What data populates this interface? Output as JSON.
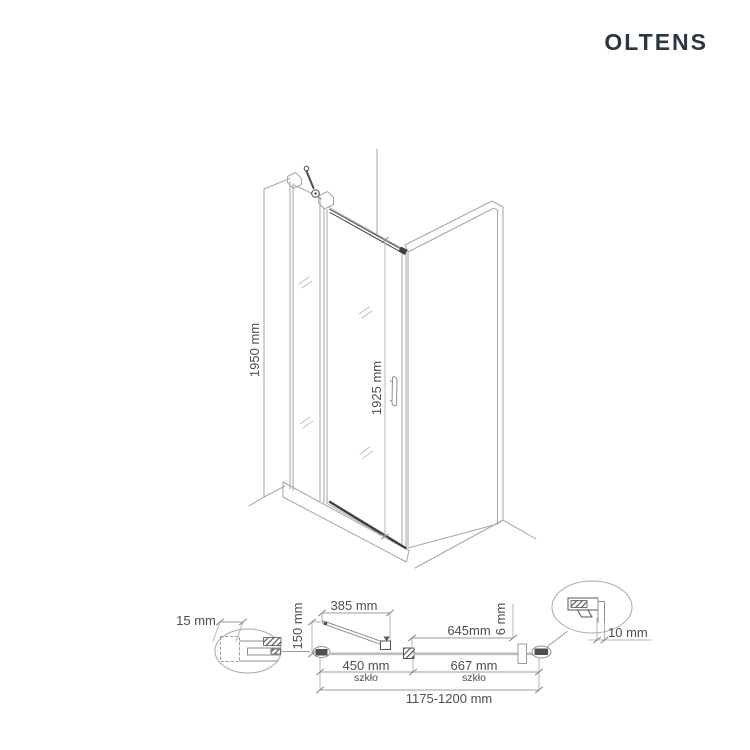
{
  "page": {
    "background_color": "#ffffff"
  },
  "brand": {
    "logo_text": "OLTENS",
    "logo_color": "#2c3544"
  },
  "drawing": {
    "line_color_light": "#a6a6a6",
    "line_color_dark": "#3f3f3f",
    "dimension_text_color": "#4a4e55"
  },
  "iso_view": {
    "total_height": "1950 mm",
    "glass_height": "1925 mm"
  },
  "plan_view": {
    "wall_offset": "15 mm",
    "door_open_width": "385 mm",
    "door_open_depth": "150 mm",
    "left_glass_width": "450 mm",
    "left_glass_material": "szkło",
    "panel_width": "645mm",
    "glass_thickness": "6 mm",
    "right_glass_width": "667 mm",
    "right_glass_material": "szkło",
    "total_width_range": "1175-1200 mm",
    "adjustment_range": "10 mm"
  }
}
